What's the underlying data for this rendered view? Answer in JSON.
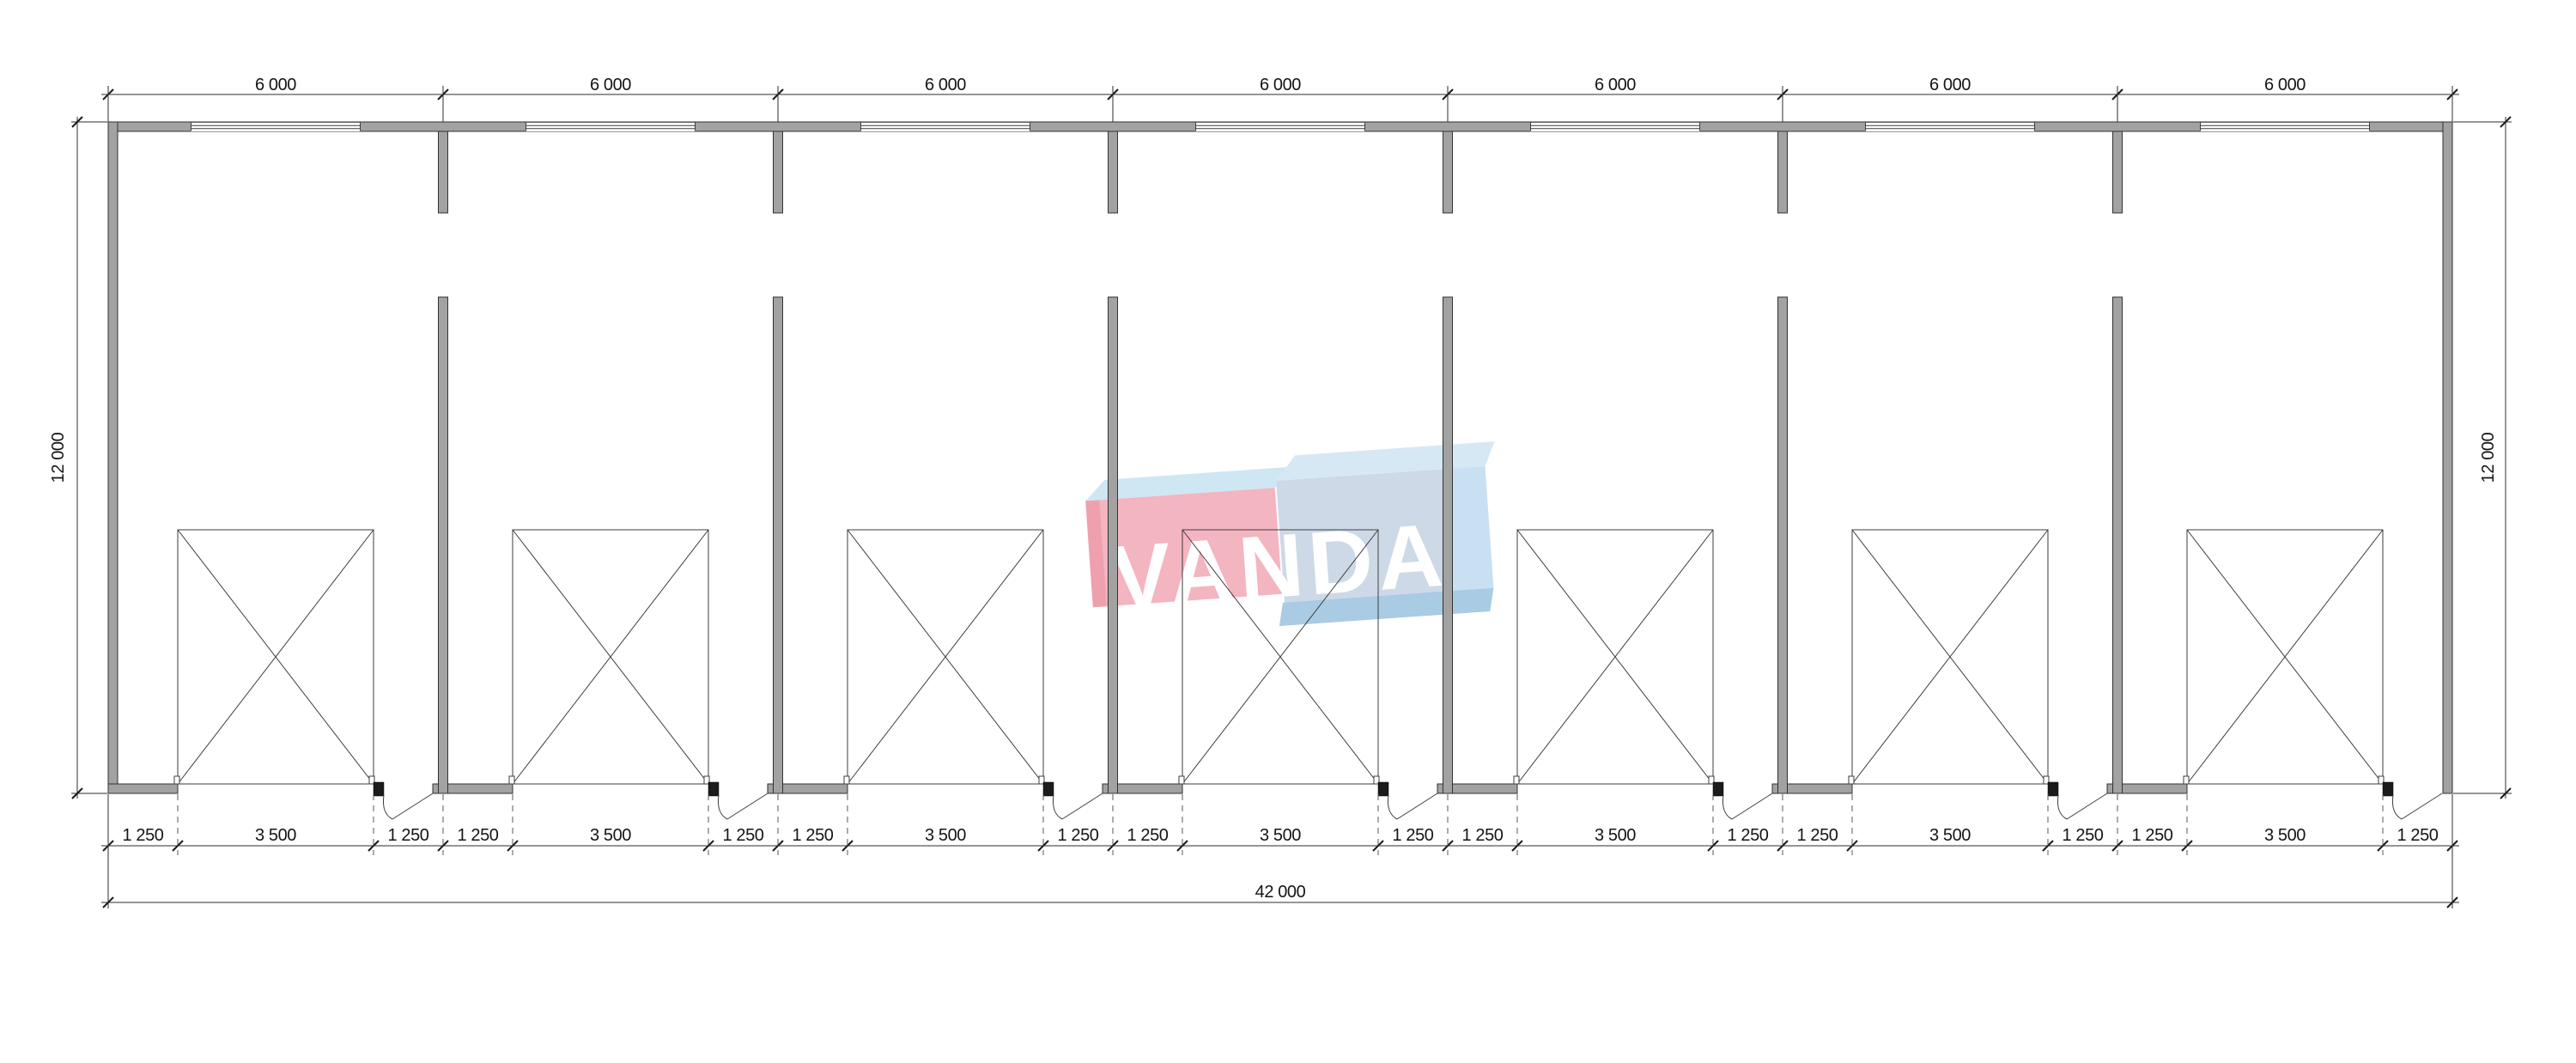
{
  "document": {
    "type": "architectural-floor-plan",
    "bays": 7
  },
  "watermark": {
    "text": "VANDA",
    "colors": {
      "pink_front": "#f3b5c0",
      "pink_side": "#efa0af",
      "pink_top": "#cfe6f3",
      "blue_front": "#cdd9e7",
      "blue_side": "#c9e0f2",
      "blue_top": "#d7e8f5",
      "blue_bottom": "#a9cbe3",
      "text": "#ffffff"
    }
  },
  "colors": {
    "wall_fill": "#a2a2a2",
    "wall_outline": "#323232",
    "line": "#3e3e3e",
    "door_jamb": "#1b1b1b",
    "dimension_text": "#141414",
    "background": "#ffffff"
  },
  "dims": {
    "top": [
      "6 000",
      "6 000",
      "6 000",
      "6 000",
      "6 000",
      "6 000",
      "6 000"
    ],
    "bottom": [
      "1 250",
      "3 500",
      "1 250",
      "1 250",
      "3 500",
      "1 250",
      "1 250",
      "3 500",
      "1 250",
      "1 250",
      "3 500",
      "1 250",
      "1 250",
      "3 500",
      "1 250",
      "1 250",
      "3 500",
      "1 250",
      "1 250",
      "3 500",
      "1 250"
    ],
    "total": "42 000",
    "left": "12 000",
    "right": "12 000"
  }
}
